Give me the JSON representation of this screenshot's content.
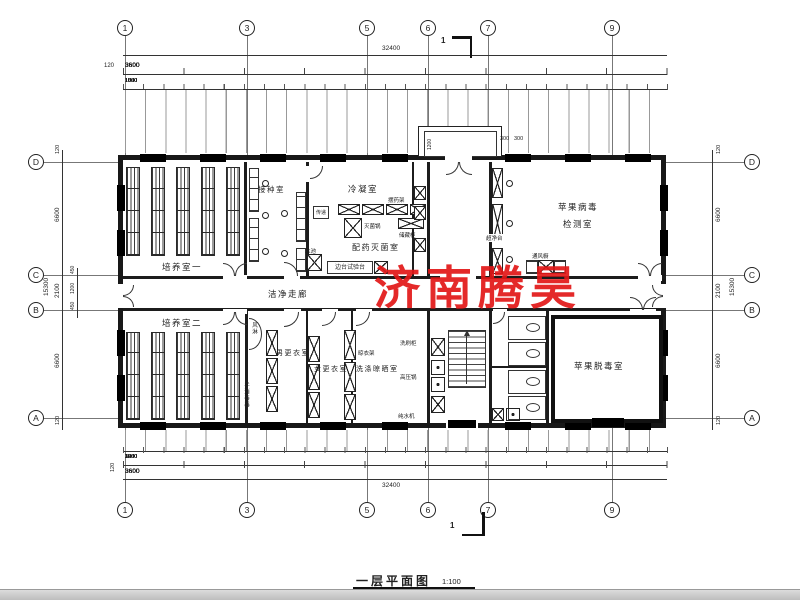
{
  "title_block": {
    "name": "一层平面图",
    "scale": "1:100"
  },
  "watermark": {
    "text": "济南腾昊",
    "color": "#e21717"
  },
  "section_mark": {
    "label": "1"
  },
  "grid": {
    "top": [
      "1",
      "3",
      "5",
      "6",
      "7",
      "9"
    ],
    "bottom": [
      "1",
      "3",
      "5",
      "6",
      "7",
      "9"
    ],
    "left": [
      "D",
      "C",
      "B",
      "A"
    ],
    "right": [
      "D",
      "C",
      "B",
      "A"
    ]
  },
  "top_dims": {
    "total": "32400",
    "edge": "120",
    "bays": [
      "3600",
      "3600",
      "3600",
      "3600",
      "3600",
      "3600",
      "3600",
      "3600",
      "3600"
    ],
    "sub": [
      "1050",
      "1500",
      "1050",
      "1050",
      "1500",
      "1050",
      "1050",
      "1500",
      "1050",
      "1050",
      "1500",
      "1050",
      "1050",
      "1500",
      "1050",
      "1050",
      "1500",
      "1050",
      "1050",
      "1500",
      "1050",
      "1050",
      "1500",
      "1050",
      "1050",
      "1500",
      "1050"
    ]
  },
  "bottom_dims": {
    "total": "32400",
    "edge": "120",
    "bays": [
      "3600",
      "3600",
      "3600",
      "3600",
      "3600",
      "3600",
      "3600",
      "3600",
      "3600"
    ],
    "sub_groups": [
      [
        "3600"
      ],
      [
        "1050",
        "1500",
        "1050"
      ],
      [
        "1050",
        "1500",
        "1050"
      ],
      [
        "1050",
        "1500",
        "1050"
      ],
      [
        "1050",
        "1500",
        "1050"
      ],
      [
        "1200",
        "1200",
        "1200"
      ],
      [
        "1050",
        "1500",
        "1050"
      ],
      [
        "1050",
        "1500",
        "1050"
      ],
      [
        "3600"
      ]
    ]
  },
  "left_dims": {
    "total": "15300",
    "segs": [
      "120",
      "6600",
      "2100",
      "6600",
      "120"
    ],
    "inner": [
      "450",
      "1200",
      "450"
    ]
  },
  "right_dims": {
    "total": "15300",
    "segs": [
      "120",
      "6600",
      "2100",
      "6600",
      "120"
    ]
  },
  "porch": {
    "v": "1200",
    "a": "300",
    "b": "300"
  },
  "rooms": {
    "peiyang1": "培养室一",
    "jiezhong": "接种室",
    "lengning": "冷凝室",
    "peiyao": "配药灭菌室",
    "bingdu_line1": "苹果病毒",
    "bingdu_line2": "检测室",
    "zoulang": "洁净走廊",
    "peiyang2": "培养室二",
    "nangeng": "男更衣室",
    "nvgeng": "女更衣室",
    "xidi": "洗涤晾晒室",
    "tuodu": "苹果脱毒室"
  },
  "equip": {
    "chuandi": "传递",
    "miejunguo": "灭菌锅",
    "baiyaojia": "摆药架",
    "chucanggui": "储藏柜",
    "shuichi": "水池",
    "biantai": "边台试验台",
    "chaojingtai": "超净台",
    "tongfengchu": "通风橱",
    "fenglin": "风淋",
    "shouxiaodu": "手消毒器",
    "liangyijia": "晾衣架",
    "xishuagui": "洗刷柜",
    "gaoyaguo": "高压锅",
    "chunshuiji": "纯水机"
  }
}
